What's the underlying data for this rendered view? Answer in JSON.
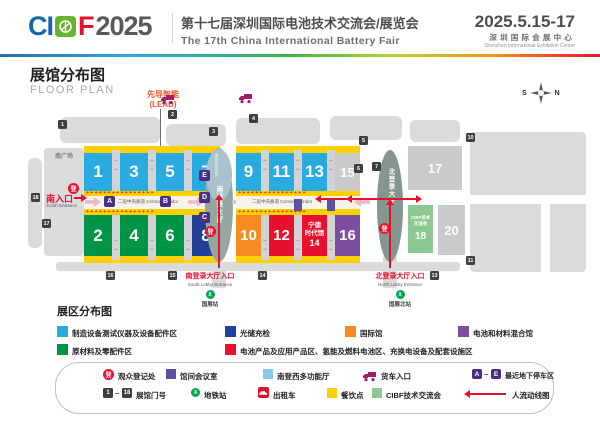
{
  "header": {
    "logo_ci": "CI",
    "logo_f": "F",
    "logo_year": "2025",
    "title_cn": "第十七届深圳国际电池技术交流会/展览会",
    "title_en": "The 17th China International Battery Fair",
    "dates": "2025.5.15-17",
    "venue_cn": "深圳国际会展中心",
    "venue_en": "Shenzhen International Exhibition Center"
  },
  "plan": {
    "title_cn": "展馆分布图",
    "title_en": "FLOOR PLAN",
    "lead_line1": "先导智能",
    "lead_line2": "(LEAD)",
    "compass": {
      "s": "S",
      "n": "N"
    },
    "south_plaza": "南广场",
    "south_entrance_cn": "南入口",
    "south_entrance_en": "South Entrance",
    "corridor_label": "二层中央廊道 Central Corridor",
    "south_lobby_top": "南登西多功能厅",
    "south_lobby": "南登录大厅",
    "north_lobby": "北登录大厅",
    "south_lobby_entrance_cn": "南登录大厅入口",
    "south_lobby_entrance_en": "South Lobby Entrance",
    "north_lobby_entrance_cn": "北登录大厅入口",
    "north_lobby_entrance_en": "North Lobby Entrance",
    "metro_south": "国展站",
    "metro_north": "国展北站",
    "reg_glyph": "登",
    "gap_arrows": "↔\n↔",
    "plus_row": "+ + + + + + + + + + + + + + + +",
    "star_glyph": "★",
    "metro_glyph": "X",
    "halls": {
      "h1": "1",
      "h2": "2",
      "h3": "3",
      "h4": "4",
      "h5": "5",
      "h6": "6",
      "h7": "7",
      "h8": "8",
      "h9": "9",
      "h10": "10",
      "h11": "11",
      "h12": "12",
      "h13": "13",
      "h14_l1": "宁德",
      "h14_l2": "时代馆",
      "h14_l3": "14",
      "h15": "15",
      "h16": "16",
      "h17": "17",
      "h18_label": "CIBF技术\n交流会",
      "h18_num": "18",
      "h20": "20"
    },
    "parking": {
      "a": "A",
      "b": "B",
      "c": "C",
      "d": "D",
      "e": "E"
    },
    "gates": {
      "g1": "1",
      "g2": "2",
      "g3": "3",
      "g4": "4",
      "g5": "5",
      "g6": "6",
      "g7": "7",
      "g10": "10",
      "g11": "11",
      "g13": "13",
      "g14": "14",
      "g15": "15",
      "g16": "16",
      "g17": "17",
      "g18": "18"
    }
  },
  "zones": {
    "title": "展区分布图",
    "items": [
      {
        "label": "制造设备测试仪器及设备配件区",
        "color": "#29abe2"
      },
      {
        "label": "光储充检",
        "color": "#21409a"
      },
      {
        "label": "国际馆",
        "color": "#f68b1f"
      },
      {
        "label": "电池和材料混合馆",
        "color": "#7d4d9f"
      },
      {
        "label": "原材料及零配件区",
        "color": "#009447"
      },
      {
        "label": "电池产品及应用产品区、氢能及燃料电池区、充换电设备及配套设施区",
        "color": "#e8112d"
      }
    ]
  },
  "legend": {
    "visitor_reg": "观众登记处",
    "meeting_room": "馆间会议室",
    "multi_hall": "南登西多功能厅",
    "truck_entrance": "货车入口",
    "parking_a": "A",
    "parking_e": "E",
    "parking_label": "最近地下停车区",
    "gate_1": "1",
    "gate_18": "18",
    "gate_label": "展馆门号",
    "metro": "地铁站",
    "taxi": "出租车",
    "food": "餐饮点",
    "cibf": "CIBF技术交流会",
    "flow": "人流动线图",
    "dash": "–"
  },
  "colors": {
    "hall_blue": "#29abe2",
    "hall_green": "#009447",
    "hall_dkblue": "#21409a",
    "hall_orange": "#f68b1f",
    "hall_red": "#e8112d",
    "hall_purple": "#7d4d9f",
    "hall_gray": "#c9cacb",
    "hall_green2": "#8cc891",
    "strip_yellow": "#fdd000",
    "parking_purple": "#4b2e83",
    "marker_black": "#3f3f41",
    "flow_red": "#e8112d",
    "truck_magenta": "#a21c67",
    "metro_green": "#00a651",
    "lead_orange": "#f15a24"
  }
}
